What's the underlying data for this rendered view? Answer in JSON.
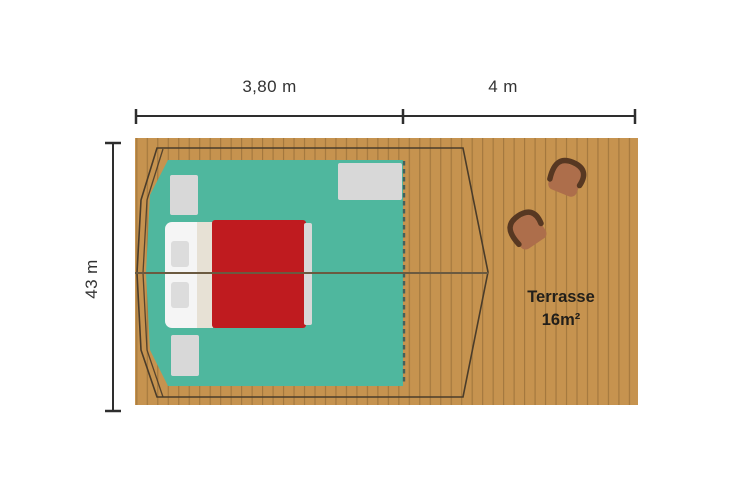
{
  "dimensions": {
    "tent_width_label": "3,80 m",
    "terrace_width_label": "4 m",
    "depth_label": "43 m"
  },
  "terrace": {
    "name": "Terrasse",
    "area": "16m²"
  },
  "colors": {
    "deck": "#C6934F",
    "tent_floor": "#4FB79E",
    "bed_blanket": "#BF1B1F",
    "bed_mattress": "#F5F5F5",
    "rug": "#D8D8D8",
    "chair_seat": "#AD6E4B",
    "chair_back": "#573822",
    "outline": "#4A3C2A",
    "dimension_line": "#2E2E2E"
  }
}
